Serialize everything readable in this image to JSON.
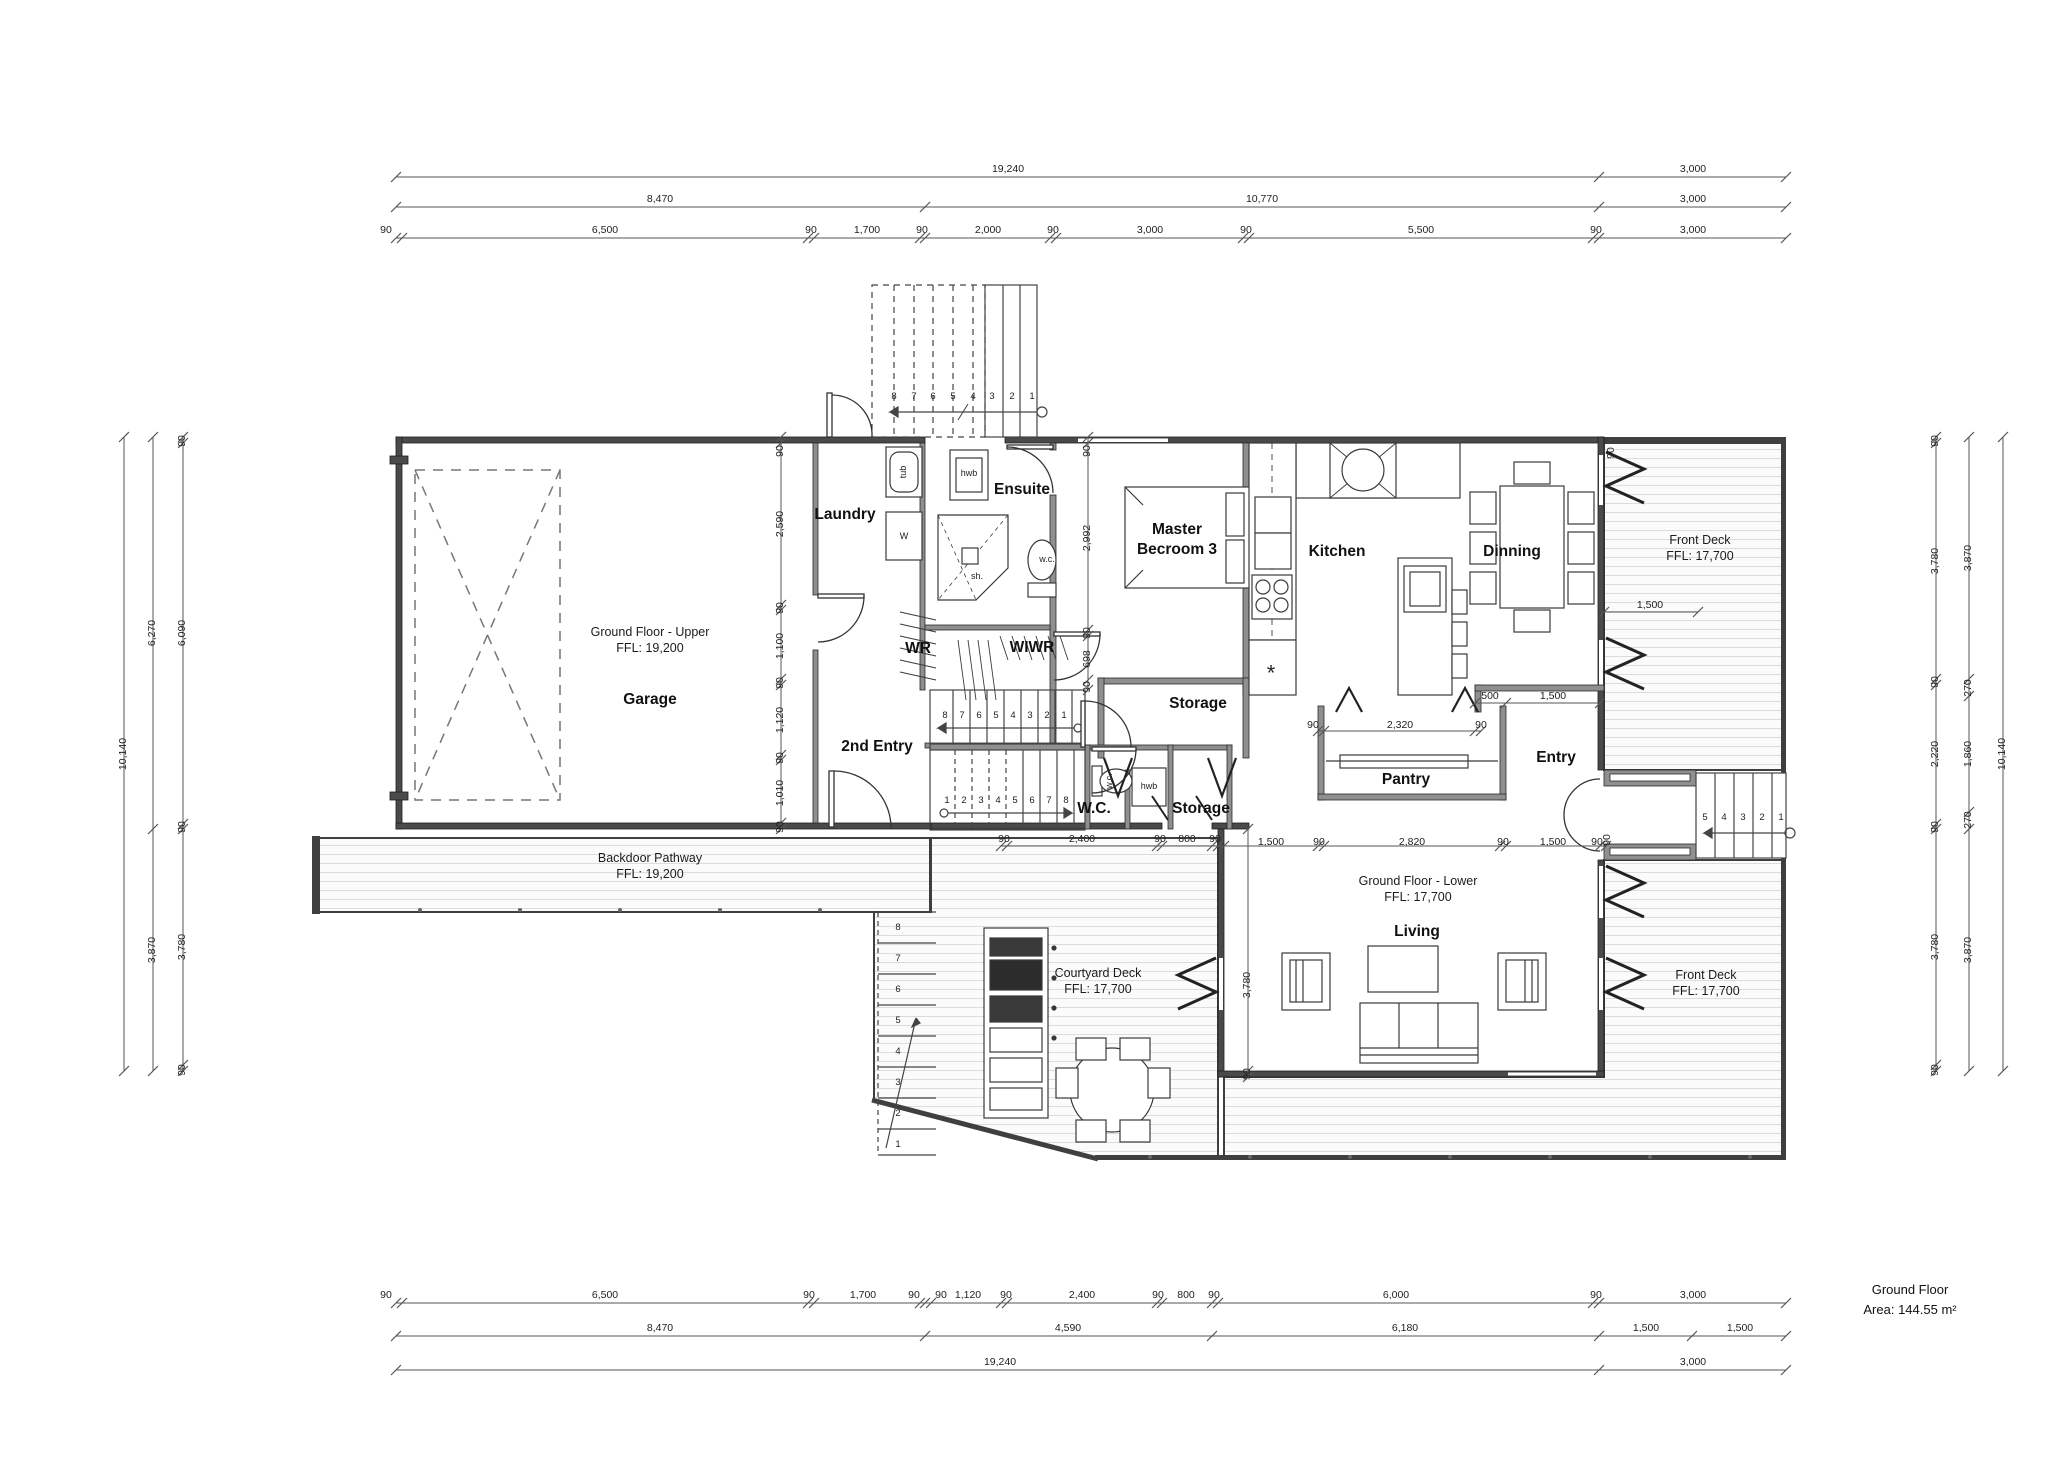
{
  "title_block": {
    "line1": "Ground Floor",
    "line2": "Area: 144.55 m²"
  },
  "colors": {
    "wall_exterior": "#4a4a4a",
    "wall_interior": "#8f8f8f",
    "line": "#333333",
    "deck_hatch": "#dcdcdc",
    "deck_edge": "#3f3f3f"
  },
  "rooms": [
    {
      "name": "room-label-garage",
      "t": "Garage",
      "x": 650,
      "y": 700
    },
    {
      "name": "room-label-laundry",
      "t": "Laundry",
      "x": 845,
      "y": 515
    },
    {
      "name": "room-label-ensuite",
      "t": "Ensuite",
      "x": 1022,
      "y": 490
    },
    {
      "name": "room-label-wr",
      "t": "WR",
      "x": 918,
      "y": 649
    },
    {
      "name": "room-label-wiwr",
      "t": "WIWR",
      "x": 1032,
      "y": 648
    },
    {
      "name": "room-label-2nd-entry",
      "t": "2nd Entry",
      "x": 877,
      "y": 747
    },
    {
      "name": "room-label-wc",
      "t": "W.C.",
      "x": 1094,
      "y": 809
    },
    {
      "name": "room-label-storage-master",
      "t": "Storage",
      "x": 1198,
      "y": 704
    },
    {
      "name": "room-label-storage-lower",
      "t": "Storage",
      "x": 1201,
      "y": 809
    },
    {
      "name": "room-label-master-bedroom",
      "t": "Master\nBecroom 3",
      "x": 1177,
      "y": 540
    },
    {
      "name": "room-label-kitchen",
      "t": "Kitchen",
      "x": 1337,
      "y": 552
    },
    {
      "name": "room-label-dining",
      "t": "Dinning",
      "x": 1512,
      "y": 552
    },
    {
      "name": "room-label-pantry",
      "t": "Pantry",
      "x": 1406,
      "y": 780
    },
    {
      "name": "room-label-entry",
      "t": "Entry",
      "x": 1556,
      "y": 758
    },
    {
      "name": "room-label-living",
      "t": "Living",
      "x": 1417,
      "y": 932
    }
  ],
  "areas": [
    {
      "name": "area-label-ground-floor-upper",
      "t": "Ground Floor - Upper\nFFL: 19,200",
      "x": 650,
      "y": 640
    },
    {
      "name": "area-label-backdoor-pathway",
      "t": "Backdoor Pathway\nFFL: 19,200",
      "x": 650,
      "y": 866
    },
    {
      "name": "area-label-front-deck-upper",
      "t": "Front Deck\nFFL: 17,700",
      "x": 1700,
      "y": 548
    },
    {
      "name": "area-label-courtyard-deck",
      "t": "Courtyard Deck\nFFL: 17,700",
      "x": 1098,
      "y": 981
    },
    {
      "name": "area-label-ground-floor-lower",
      "t": "Ground Floor - Lower\nFFL: 17,700",
      "x": 1418,
      "y": 889
    },
    {
      "name": "area-label-front-deck-lower",
      "t": "Front Deck\nFFL: 17,700",
      "x": 1706,
      "y": 983
    }
  ],
  "fixtures": [
    {
      "t": "tub",
      "x": 904,
      "y": 472,
      "r": 1
    },
    {
      "t": "W",
      "x": 904,
      "y": 537
    },
    {
      "t": "hwb",
      "x": 969,
      "y": 474
    },
    {
      "t": "sh.",
      "x": 977,
      "y": 577
    },
    {
      "t": "w.c.",
      "x": 1047,
      "y": 560
    },
    {
      "t": "w.c.",
      "x": 1110,
      "y": 781,
      "r": 1
    },
    {
      "t": "hwb",
      "x": 1149,
      "y": 787
    },
    {
      "t": "*",
      "x": 1271,
      "y": 674,
      "sz": "lg"
    }
  ],
  "stair_numbers": [
    {
      "t": "8",
      "x": 894,
      "y": 397
    },
    {
      "t": "7",
      "x": 914,
      "y": 397
    },
    {
      "t": "6",
      "x": 933,
      "y": 397
    },
    {
      "t": "5",
      "x": 953,
      "y": 397
    },
    {
      "t": "4",
      "x": 973,
      "y": 397
    },
    {
      "t": "3",
      "x": 992,
      "y": 397
    },
    {
      "t": "2",
      "x": 1012,
      "y": 397
    },
    {
      "t": "1",
      "x": 1032,
      "y": 397
    },
    {
      "t": "8",
      "x": 945,
      "y": 716
    },
    {
      "t": "7",
      "x": 962,
      "y": 716
    },
    {
      "t": "6",
      "x": 979,
      "y": 716
    },
    {
      "t": "5",
      "x": 996,
      "y": 716
    },
    {
      "t": "4",
      "x": 1013,
      "y": 716
    },
    {
      "t": "3",
      "x": 1030,
      "y": 716
    },
    {
      "t": "2",
      "x": 1047,
      "y": 716
    },
    {
      "t": "1",
      "x": 1064,
      "y": 716
    },
    {
      "t": "1",
      "x": 947,
      "y": 801
    },
    {
      "t": "2",
      "x": 964,
      "y": 801
    },
    {
      "t": "3",
      "x": 981,
      "y": 801
    },
    {
      "t": "4",
      "x": 998,
      "y": 801
    },
    {
      "t": "5",
      "x": 1015,
      "y": 801
    },
    {
      "t": "6",
      "x": 1032,
      "y": 801
    },
    {
      "t": "7",
      "x": 1049,
      "y": 801
    },
    {
      "t": "8",
      "x": 1066,
      "y": 801
    },
    {
      "t": "8",
      "x": 898,
      "y": 928
    },
    {
      "t": "7",
      "x": 898,
      "y": 959
    },
    {
      "t": "6",
      "x": 898,
      "y": 990
    },
    {
      "t": "5",
      "x": 898,
      "y": 1021
    },
    {
      "t": "4",
      "x": 898,
      "y": 1052
    },
    {
      "t": "3",
      "x": 898,
      "y": 1083
    },
    {
      "t": "2",
      "x": 898,
      "y": 1114
    },
    {
      "t": "1",
      "x": 898,
      "y": 1145
    },
    {
      "t": "5",
      "x": 1705,
      "y": 818
    },
    {
      "t": "4",
      "x": 1724,
      "y": 818
    },
    {
      "t": "3",
      "x": 1743,
      "y": 818
    },
    {
      "t": "2",
      "x": 1762,
      "y": 818
    },
    {
      "t": "1",
      "x": 1781,
      "y": 818
    }
  ],
  "dims": [
    {
      "t": "19,240",
      "x": 1008,
      "y": 170
    },
    {
      "t": "3,000",
      "x": 1693,
      "y": 170
    },
    {
      "t": "8,470",
      "x": 660,
      "y": 200
    },
    {
      "t": "10,770",
      "x": 1262,
      "y": 200
    },
    {
      "t": "3,000",
      "x": 1693,
      "y": 200
    },
    {
      "t": "90",
      "x": 386,
      "y": 231
    },
    {
      "t": "6,500",
      "x": 605,
      "y": 231
    },
    {
      "t": "90",
      "x": 811,
      "y": 231
    },
    {
      "t": "1,700",
      "x": 867,
      "y": 231
    },
    {
      "t": "90",
      "x": 922,
      "y": 231
    },
    {
      "t": "2,000",
      "x": 988,
      "y": 231
    },
    {
      "t": "90",
      "x": 1053,
      "y": 231
    },
    {
      "t": "3,000",
      "x": 1150,
      "y": 231
    },
    {
      "t": "90",
      "x": 1246,
      "y": 231
    },
    {
      "t": "5,500",
      "x": 1421,
      "y": 231
    },
    {
      "t": "90",
      "x": 1596,
      "y": 231
    },
    {
      "t": "3,000",
      "x": 1693,
      "y": 231
    },
    {
      "t": "90",
      "x": 386,
      "y": 1296
    },
    {
      "t": "6,500",
      "x": 605,
      "y": 1296
    },
    {
      "t": "90",
      "x": 809,
      "y": 1296
    },
    {
      "t": "1,700",
      "x": 863,
      "y": 1296
    },
    {
      "t": "90",
      "x": 914,
      "y": 1296
    },
    {
      "t": "90",
      "x": 941,
      "y": 1296
    },
    {
      "t": "1,120",
      "x": 968,
      "y": 1296
    },
    {
      "t": "90",
      "x": 1006,
      "y": 1296
    },
    {
      "t": "2,400",
      "x": 1082,
      "y": 1296
    },
    {
      "t": "90",
      "x": 1158,
      "y": 1296
    },
    {
      "t": "800",
      "x": 1186,
      "y": 1296
    },
    {
      "t": "90",
      "x": 1214,
      "y": 1296
    },
    {
      "t": "6,000",
      "x": 1396,
      "y": 1296
    },
    {
      "t": "90",
      "x": 1596,
      "y": 1296
    },
    {
      "t": "3,000",
      "x": 1693,
      "y": 1296
    },
    {
      "t": "8,470",
      "x": 660,
      "y": 1329
    },
    {
      "t": "4,590",
      "x": 1068,
      "y": 1329
    },
    {
      "t": "6,180",
      "x": 1405,
      "y": 1329
    },
    {
      "t": "1,500",
      "x": 1646,
      "y": 1329
    },
    {
      "t": "1,500",
      "x": 1740,
      "y": 1329
    },
    {
      "t": "19,240",
      "x": 1000,
      "y": 1363
    },
    {
      "t": "3,000",
      "x": 1693,
      "y": 1363
    },
    {
      "t": "10,140",
      "x": 124,
      "y": 754,
      "r": 1
    },
    {
      "t": "6,270",
      "x": 153,
      "y": 633,
      "r": 1
    },
    {
      "t": "3,870",
      "x": 153,
      "y": 950,
      "r": 1
    },
    {
      "t": "90",
      "x": 183,
      "y": 441,
      "r": 1
    },
    {
      "t": "6,090",
      "x": 183,
      "y": 633,
      "r": 1
    },
    {
      "t": "90",
      "x": 183,
      "y": 827,
      "r": 1
    },
    {
      "t": "3,780",
      "x": 183,
      "y": 947,
      "r": 1
    },
    {
      "t": "90",
      "x": 183,
      "y": 1070,
      "r": 1
    },
    {
      "t": "90",
      "x": 1936,
      "y": 441,
      "r": 1
    },
    {
      "t": "3,780",
      "x": 1936,
      "y": 561,
      "r": 1
    },
    {
      "t": "90",
      "x": 1936,
      "y": 682,
      "r": 1
    },
    {
      "t": "2,220",
      "x": 1936,
      "y": 754,
      "r": 1
    },
    {
      "t": "90",
      "x": 1936,
      "y": 827,
      "r": 1
    },
    {
      "t": "3,780",
      "x": 1936,
      "y": 947,
      "r": 1
    },
    {
      "t": "90",
      "x": 1936,
      "y": 1070,
      "r": 1
    },
    {
      "t": "3,870",
      "x": 1969,
      "y": 558,
      "r": 1
    },
    {
      "t": "270",
      "x": 1969,
      "y": 688,
      "r": 1
    },
    {
      "t": "1,860",
      "x": 1969,
      "y": 754,
      "r": 1
    },
    {
      "t": "270",
      "x": 1969,
      "y": 820,
      "r": 1
    },
    {
      "t": "3,870",
      "x": 1969,
      "y": 950,
      "r": 1
    },
    {
      "t": "10,140",
      "x": 2003,
      "y": 754,
      "r": 1
    },
    {
      "t": "90",
      "x": 781,
      "y": 451,
      "r": 1
    },
    {
      "t": "2,590",
      "x": 781,
      "y": 524,
      "r": 1
    },
    {
      "t": "90",
      "x": 781,
      "y": 608,
      "r": 1
    },
    {
      "t": "1,100",
      "x": 781,
      "y": 646,
      "r": 1
    },
    {
      "t": "90",
      "x": 781,
      "y": 683,
      "r": 1
    },
    {
      "t": "1,120",
      "x": 781,
      "y": 720,
      "r": 1
    },
    {
      "t": "90",
      "x": 781,
      "y": 758,
      "r": 1
    },
    {
      "t": "1,010",
      "x": 781,
      "y": 793,
      "r": 1
    },
    {
      "t": "90",
      "x": 781,
      "y": 827,
      "r": 1
    },
    {
      "t": "90",
      "x": 1088,
      "y": 451,
      "r": 1
    },
    {
      "t": "2,992",
      "x": 1088,
      "y": 538,
      "r": 1
    },
    {
      "t": "90",
      "x": 1088,
      "y": 633,
      "r": 1
    },
    {
      "t": "698",
      "x": 1088,
      "y": 659,
      "r": 1
    },
    {
      "t": "90",
      "x": 1088,
      "y": 687,
      "r": 1
    },
    {
      "t": "90",
      "x": 1612,
      "y": 453,
      "r": 1
    },
    {
      "t": "90",
      "x": 1608,
      "y": 840,
      "r": 1
    },
    {
      "t": "3,780",
      "x": 1248,
      "y": 985,
      "r": 1
    },
    {
      "t": "90",
      "x": 1248,
      "y": 1074,
      "r": 1
    },
    {
      "t": "90",
      "x": 1004,
      "y": 840
    },
    {
      "t": "2,400",
      "x": 1082,
      "y": 840
    },
    {
      "t": "90",
      "x": 1160,
      "y": 840
    },
    {
      "t": "800",
      "x": 1187,
      "y": 840
    },
    {
      "t": "90",
      "x": 1215,
      "y": 840
    },
    {
      "t": "1,500",
      "x": 1271,
      "y": 843
    },
    {
      "t": "90",
      "x": 1319,
      "y": 843
    },
    {
      "t": "2,820",
      "x": 1412,
      "y": 843
    },
    {
      "t": "90",
      "x": 1503,
      "y": 843
    },
    {
      "t": "1,500",
      "x": 1553,
      "y": 843
    },
    {
      "t": "90",
      "x": 1597,
      "y": 843
    },
    {
      "t": "90",
      "x": 1313,
      "y": 726
    },
    {
      "t": "2,320",
      "x": 1400,
      "y": 726
    },
    {
      "t": "90",
      "x": 1481,
      "y": 726
    },
    {
      "t": "500",
      "x": 1490,
      "y": 697
    },
    {
      "t": "1,500",
      "x": 1553,
      "y": 697
    },
    {
      "t": "1,500",
      "x": 1650,
      "y": 606
    }
  ]
}
